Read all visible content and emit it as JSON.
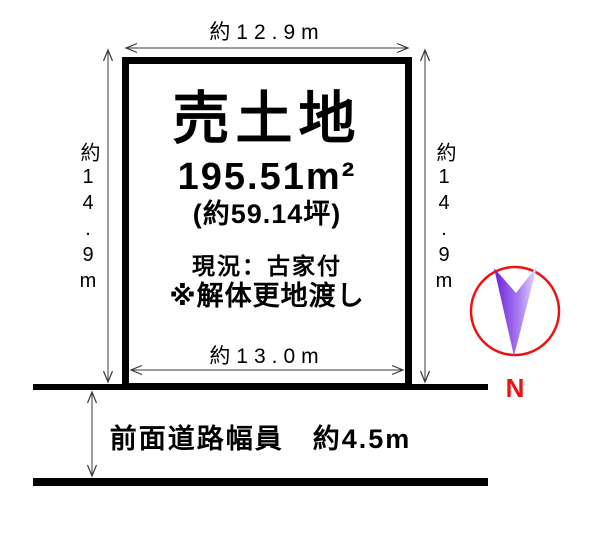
{
  "dimensions": {
    "top_width": "約12.9m",
    "bottom_width": "約13.0m",
    "left_height": "約14.9m",
    "right_height": "約14.9m"
  },
  "plot": {
    "title": "売土地",
    "area_sqm": "195.51m²",
    "area_tsubo": "(約59.14坪)",
    "status_current": "現況：古家付",
    "status_note": "※解体更地渡し"
  },
  "road": {
    "width_label": "前面道路幅員　約4.5m"
  },
  "compass": {
    "north_label": "N"
  },
  "colors": {
    "boundary_black": "#000000",
    "dimension_line_gray": "#3a3a3a",
    "compass_circle_red": "#ee1111",
    "north_letter_red": "#ee1111",
    "north_arrow_purple_dark": "#6a1fd8",
    "north_arrow_purple_light": "#e8dcff"
  }
}
